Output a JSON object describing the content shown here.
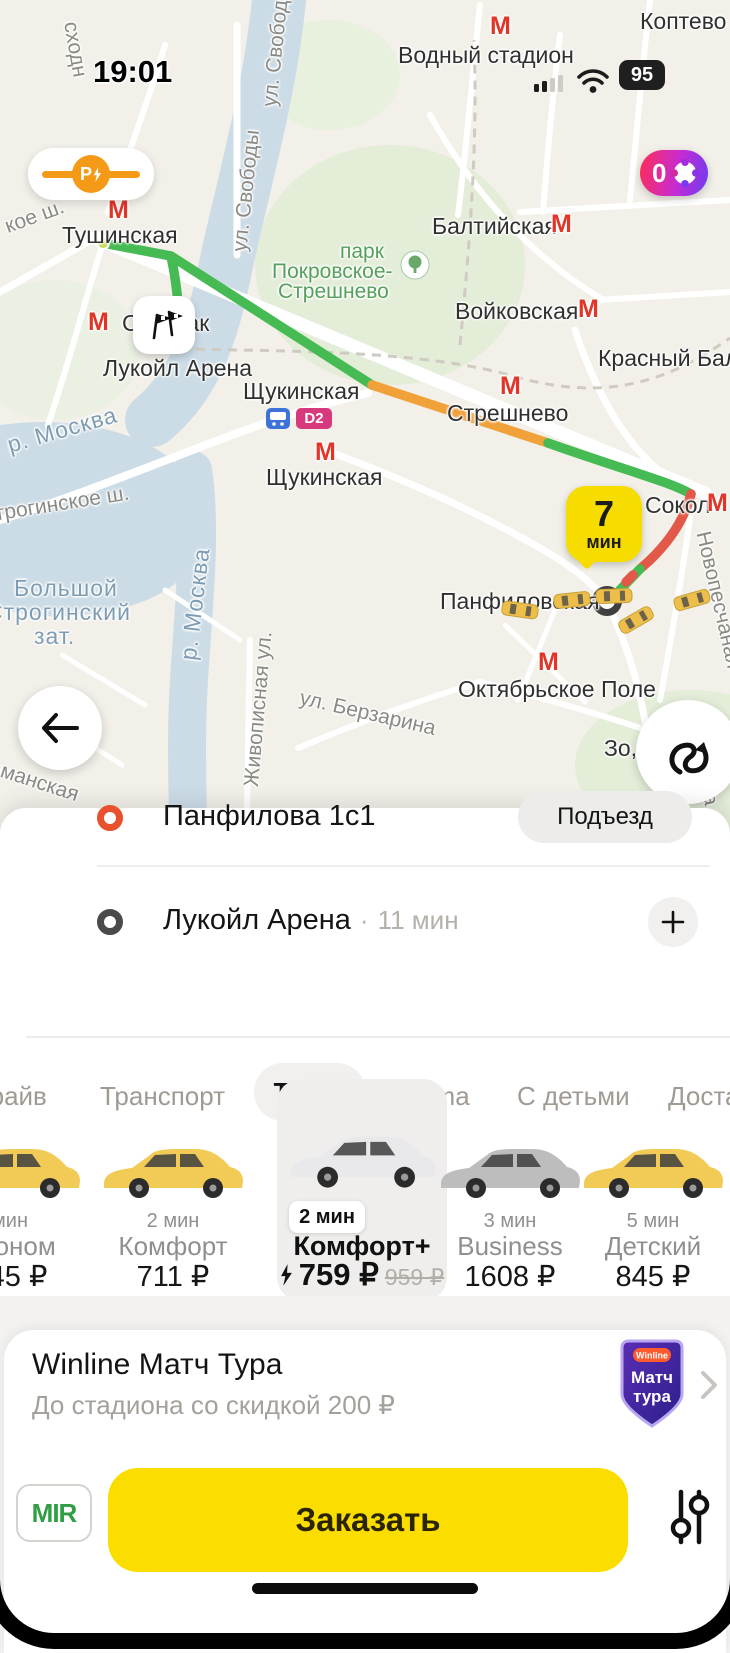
{
  "status_bar": {
    "time": "19:01",
    "battery": "95"
  },
  "map": {
    "metro_letter": "М",
    "d2_badge": "D2",
    "toll_badge": {
      "letter": "Р"
    },
    "plus_badge": {
      "count": "0"
    },
    "eta_bubble": {
      "value": "7",
      "unit": "мин"
    },
    "stations": {
      "vodny": "Водный стадион",
      "tushinskaya": "Тушинская",
      "spartak": "Спартак",
      "baltiyskaya": "Балтийская",
      "voykovskaya": "Войковская",
      "krasny_baltiets": "Красный Балтиец",
      "streshnevo": "Стрешнево",
      "shchukinskaya": "Щукинская",
      "sokol": "Сокол",
      "panfilovskaya": "Панфиловская",
      "oktyabrskoye_pole": "Октябрьское Поле"
    },
    "places": {
      "koptevo": "Коптево",
      "park_word": "парк",
      "park_name1": "Покровское-",
      "park_name2": "Стрешнево",
      "lukoil_arena": "Лукойл Арена",
      "bolshoy": "Большой",
      "stroginsky": "Строгинский",
      "zat": "зат.",
      "zo": "Зо,"
    },
    "streets": {
      "svobody": "ул. Свободы",
      "berzarina": "ул. Берзарина",
      "zhivopisnaya": "Живописная ул.",
      "novopeschanaya": "Новопесчаная",
      "stroginskoe": "Строгинское ш.",
      "koe_sh": "кое ш.",
      "skhodn": "сходн",
      "amanskaya": "аманская",
      "mena": "мена",
      "moskva_river": "р. Москва"
    }
  },
  "route_panel": {
    "pickup": {
      "address": "Панфилова 1с1",
      "entrance_button": "Подъезд"
    },
    "destination": {
      "address": "Лукойл Арена",
      "separator": "·",
      "eta": "11 мин"
    }
  },
  "tabs": [
    {
      "label": "Драйв"
    },
    {
      "label": "Транспорт"
    },
    {
      "label": "Такси"
    },
    {
      "label": "Ultima"
    },
    {
      "label": "С детьми"
    },
    {
      "label": "Доставка"
    }
  ],
  "tariffs": [
    {
      "eta": "мин",
      "name": "Эконом",
      "price": "645 ₽"
    },
    {
      "eta": "2 мин",
      "name": "Комфорт",
      "price": "711 ₽"
    },
    {
      "eta": "2 мин",
      "name": "Комфорт+",
      "price": "759 ₽",
      "old_price": "959 ₽"
    },
    {
      "eta": "3 мин",
      "name": "Business",
      "price": "1608 ₽"
    },
    {
      "eta": "5 мин",
      "name": "Детский",
      "price": "845 ₽"
    }
  ],
  "banner": {
    "title": "Winline Матч Тура",
    "subtitle": "До стадиона со скидкой 200 ₽",
    "logo": {
      "top": "Winline",
      "line1": "Матч",
      "line2": "тура"
    }
  },
  "order": {
    "payment_label": "MIR",
    "submit_label": "Заказать"
  },
  "colors": {
    "accent_yellow": "#fcdd00",
    "route_green": "#46bb54",
    "route_orange": "#f0a13a",
    "route_red": "#e2594a",
    "metro_red": "#e13528",
    "toll_orange": "#f59a16",
    "plus_gradient_start": "#ff2d55",
    "plus_gradient_end": "#6d3df0"
  }
}
